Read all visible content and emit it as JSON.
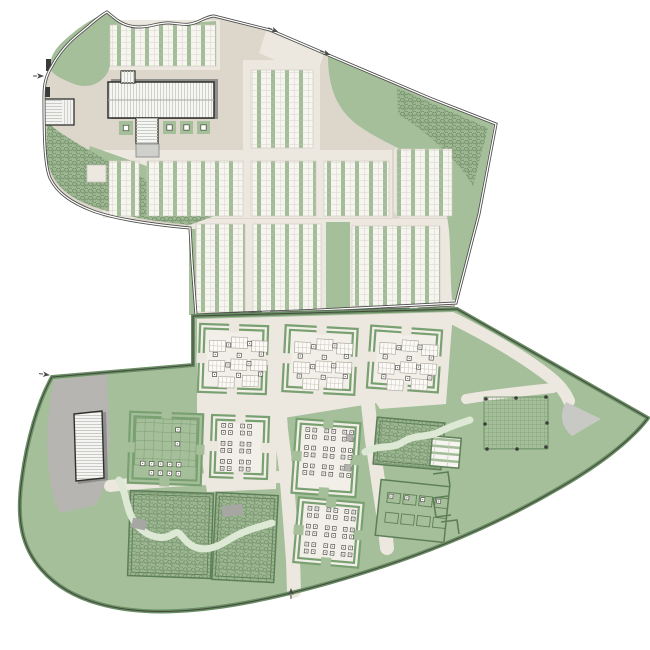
{
  "meta": {
    "drawing_type": "landscape-masterplan-site-plan",
    "canvas_width": 650,
    "canvas_height": 650
  },
  "palette": {
    "paper": "#ffffff",
    "beige": "#dcd6cb",
    "cream": "#ece8e0",
    "cream_light": "#f2efe8",
    "lawn": "#a5bf9a",
    "hedge": "#79a071",
    "hedge_dark": "#5d7f57",
    "edge_green": "#6b8f64",
    "ink": "#4a4a48",
    "building_fill": "#f6f6f3",
    "building_line": "#2f2f2d",
    "shadow": "#8e8e8c",
    "parking": "#b6b5b2",
    "apron": "#cfcfcc",
    "wedge": "#c8c8c5",
    "stream": "#dde8d5",
    "culvert": "#a6a6a3",
    "plot_green": "#a2bd98",
    "grid_line": "#6d9065"
  },
  "upper_site": {
    "stripe_blocks": [
      [
        110,
        25,
        106,
        41
      ],
      [
        251,
        70,
        62,
        78
      ],
      [
        109,
        161,
        30,
        55
      ],
      [
        147,
        161,
        96,
        55
      ],
      [
        251,
        161,
        65,
        55
      ],
      [
        324,
        161,
        65,
        55
      ],
      [
        397,
        149,
        55,
        67
      ],
      [
        196,
        224,
        49,
        88
      ],
      [
        253,
        224,
        68,
        88
      ],
      [
        352,
        226,
        88,
        80
      ]
    ],
    "green_band": [
      326,
      222,
      24,
      90
    ],
    "planters": [
      [
        119,
        121,
        14
      ],
      [
        163,
        121,
        13
      ],
      [
        180,
        121,
        13
      ],
      [
        197,
        121,
        13
      ]
    ],
    "wall_segments": [
      [
        197,
        315,
        262,
        313
      ],
      [
        270,
        313,
        410,
        309
      ],
      [
        418,
        309,
        455,
        307
      ]
    ]
  },
  "lower_site": {
    "courtyards": [
      {
        "id": "court-nw",
        "x": 199,
        "y": 325,
        "w": 68,
        "h": 68,
        "rot": 2,
        "wall": "hedge",
        "interior": "cream_light",
        "ground": "cream",
        "content": "tables"
      },
      {
        "id": "court-n",
        "x": 284,
        "y": 327,
        "w": 72,
        "h": 66,
        "rot": 3,
        "wall": "hedge",
        "interior": "cream_light",
        "ground": "cream",
        "content": "tables"
      },
      {
        "id": "court-ne",
        "x": 369,
        "y": 328,
        "w": 71,
        "h": 62,
        "rot": 4,
        "wall": "hedge",
        "interior": "cream_light",
        "ground": "cream",
        "content": "tables"
      },
      {
        "id": "court-grid",
        "x": 129,
        "y": 413,
        "w": 73,
        "h": 71,
        "rot": 2,
        "wall": "hedge",
        "interior": "lawn",
        "ground": "lawn",
        "content": "grid"
      },
      {
        "id": "court-c1",
        "x": 211,
        "y": 416,
        "w": 57,
        "h": 62,
        "rot": 2,
        "wall": "hedge",
        "interior": "cream_light",
        "ground": "cream",
        "content": "clusters"
      },
      {
        "id": "court-c2",
        "x": 294,
        "y": 421,
        "w": 64,
        "h": 74,
        "rot": 4,
        "wall": "hedge",
        "interior": "cream_light",
        "ground": "lawn",
        "content": "clusters",
        "gray_squares": true
      },
      {
        "id": "hedge-block-e",
        "x": 375,
        "y": 420,
        "w": 68,
        "h": 47,
        "rot": 5,
        "wall": "line",
        "interior": "hedge_texture"
      },
      {
        "id": "plot-block-small",
        "x": 431,
        "y": 437,
        "w": 29,
        "h": 30,
        "rot": 5,
        "wall": "line",
        "interior": "plot_h"
      },
      {
        "id": "hedge-block-sw",
        "x": 129,
        "y": 492,
        "w": 83,
        "h": 85,
        "rot": 2,
        "wall": "line",
        "interior": "hedge_texture"
      },
      {
        "id": "hedge-block-s",
        "x": 214,
        "y": 494,
        "w": 62,
        "h": 87,
        "rot": 3,
        "wall": "line",
        "interior": "hedge_texture"
      },
      {
        "id": "court-s",
        "x": 296,
        "y": 500,
        "w": 65,
        "h": 65,
        "rot": 5,
        "wall": "hedge",
        "interior": "cream_light",
        "ground": "lawn",
        "content": "clusters"
      },
      {
        "id": "court-plots",
        "x": 378,
        "y": 483,
        "w": 69,
        "h": 56,
        "rot": 6,
        "wall": "line",
        "interior": "lawn",
        "content": "plots"
      }
    ],
    "grid_square": {
      "x": 484,
      "y": 397,
      "w": 64,
      "h": 52,
      "dots": [
        [
          486,
          399
        ],
        [
          516,
          398
        ],
        [
          546,
          397
        ],
        [
          485,
          424
        ],
        [
          547,
          423
        ],
        [
          487,
          449
        ],
        [
          517,
          449
        ],
        [
          546,
          447
        ]
      ]
    },
    "content_offsets": {
      "tables_rects": [
        [
          10,
          16
        ],
        [
          32,
          12
        ],
        [
          52,
          15
        ],
        [
          10,
          36
        ],
        [
          32,
          34
        ],
        [
          52,
          34
        ],
        [
          20,
          52
        ],
        [
          44,
          50
        ]
      ],
      "tables_squares": [
        [
          27,
          18
        ],
        [
          48,
          16
        ],
        [
          27,
          38
        ],
        [
          48,
          36
        ],
        [
          14,
          28
        ],
        [
          38,
          28
        ],
        [
          14,
          48
        ],
        [
          60,
          26
        ],
        [
          60,
          46
        ],
        [
          38,
          48
        ]
      ],
      "cluster_origins": [
        [
          10,
          8
        ],
        [
          29,
          8
        ],
        [
          47,
          8
        ],
        [
          10,
          26
        ],
        [
          29,
          26
        ],
        [
          47,
          26
        ],
        [
          10,
          44
        ],
        [
          29,
          44
        ],
        [
          47,
          44
        ]
      ],
      "cluster_cells": [
        [
          0,
          0
        ],
        [
          7,
          0
        ],
        [
          0,
          7
        ],
        [
          7,
          7
        ]
      ],
      "grid_squares": [
        [
          12,
          49
        ],
        [
          21,
          49
        ],
        [
          30,
          49
        ],
        [
          39,
          49
        ],
        [
          48,
          49
        ],
        [
          21,
          58
        ],
        [
          30,
          58
        ],
        [
          39,
          58
        ],
        [
          48,
          58
        ],
        [
          46,
          14
        ],
        [
          46,
          28
        ]
      ],
      "plots_rows": [
        12,
        32
      ],
      "plots_cols": [
        8,
        24,
        40,
        56
      ]
    }
  },
  "markers": [
    {
      "name": "gate-arrow-north-1",
      "x": 271,
      "y": 29,
      "angle": 22
    },
    {
      "name": "gate-arrow-north-2",
      "x": 323,
      "y": 52,
      "angle": 22
    },
    {
      "name": "gate-arrow-west-upper",
      "x": 36,
      "y": 76,
      "angle": 0
    },
    {
      "name": "gate-arrow-west-lower",
      "x": 42,
      "y": 374,
      "angle": 8
    },
    {
      "name": "gate-arrow-south",
      "x": 291,
      "y": 596,
      "angle": -90
    }
  ]
}
